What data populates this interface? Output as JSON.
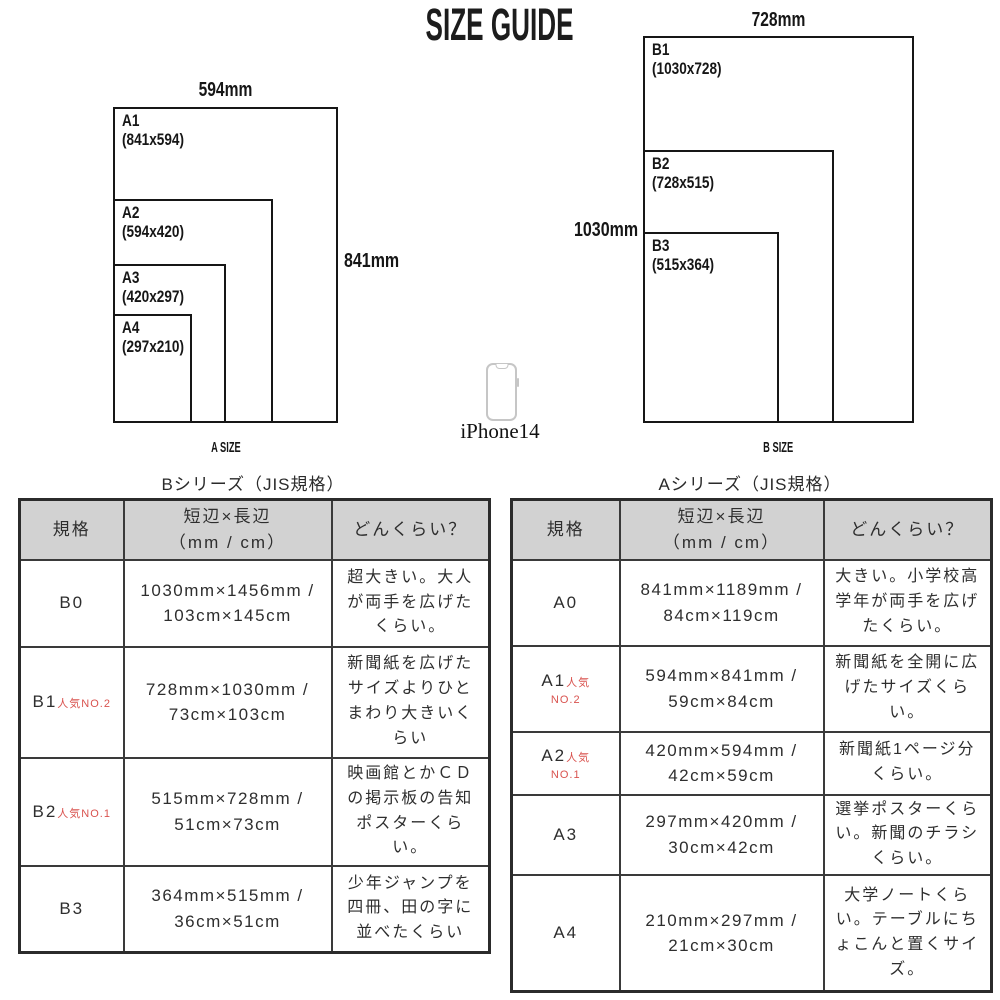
{
  "page": {
    "title": "SIZE GUIDE"
  },
  "colors": {
    "accent_red": "#d9534f",
    "header_gray": "#d2d2d2",
    "line_dark": "#2b2b2b",
    "phone_gray": "#c6c6c6"
  },
  "diagrams": {
    "a": {
      "caption": "A SIZE",
      "top_label": "594mm",
      "side_label": "841mm",
      "boxes": [
        {
          "name": "A1",
          "dims": "(841x594)"
        },
        {
          "name": "A2",
          "dims": "(594x420)"
        },
        {
          "name": "A3",
          "dims": "(420x297)"
        },
        {
          "name": "A4",
          "dims": "(297x210)"
        }
      ]
    },
    "b": {
      "caption": "B SIZE",
      "top_label": "728mm",
      "side_label": "1030mm",
      "boxes": [
        {
          "name": "B1",
          "dims": "(1030x728)"
        },
        {
          "name": "B2",
          "dims": "(728x515)"
        },
        {
          "name": "B3",
          "dims": "(515x364)"
        }
      ]
    }
  },
  "phone": {
    "label": "iPhone14"
  },
  "tables": {
    "b_series": {
      "title": "Bシリーズ（JIS規格）",
      "headers": {
        "spec": "規格",
        "size_l1": "短辺×長辺",
        "size_l2": "（mm / cm）",
        "how": "どんくらい？"
      },
      "rows": [
        {
          "spec": "B0",
          "size": "1030mm×1456mm / 103cm×145cm",
          "desc": "超大きい。大人が両手を広げたくらい。"
        },
        {
          "spec": "B1",
          "badge": "人気NO.2",
          "size": "728mm×1030mm / 73cm×103cm",
          "desc": "新聞紙を広げたサイズよりひとまわり大きいくらい"
        },
        {
          "spec": "B2",
          "badge": "人気NO.1",
          "size": "515mm×728mm / 51cm×73cm",
          "desc": "映画館とかＣＤの掲示板の告知ポスターくらい。"
        },
        {
          "spec": "B3",
          "size": "364mm×515mm / 36cm×51cm",
          "desc": "少年ジャンプを四冊、田の字に並べたくらい"
        }
      ]
    },
    "a_series": {
      "title": "Aシリーズ（JIS規格）",
      "headers": {
        "spec": "規格",
        "size_l1": "短辺×長辺",
        "size_l2": "（mm / cm）",
        "how": "どんくらい？"
      },
      "rows": [
        {
          "spec": "A0",
          "size": "841mm×1189mm / 84cm×119cm",
          "desc": "大きい。小学校高学年が両手を広げたくらい。"
        },
        {
          "spec": "A1",
          "badge": "人気",
          "badge2": "NO.2",
          "size": "594mm×841mm / 59cm×84cm",
          "desc": "新聞紙を全開に広げたサイズくらい。"
        },
        {
          "spec": "A2",
          "badge": "人気",
          "badge2": "NO.1",
          "size": "420mm×594mm / 42cm×59cm",
          "desc": "新聞紙1ページ分くらい。"
        },
        {
          "spec": "A3",
          "size": "297mm×420mm / 30cm×42cm",
          "desc": "選挙ポスターくらい。新聞のチラシくらい。"
        },
        {
          "spec": "A4",
          "size": "210mm×297mm / 21cm×30cm",
          "desc": "大学ノートくらい。テーブルにちょこんと置くサイズ。"
        }
      ]
    }
  }
}
